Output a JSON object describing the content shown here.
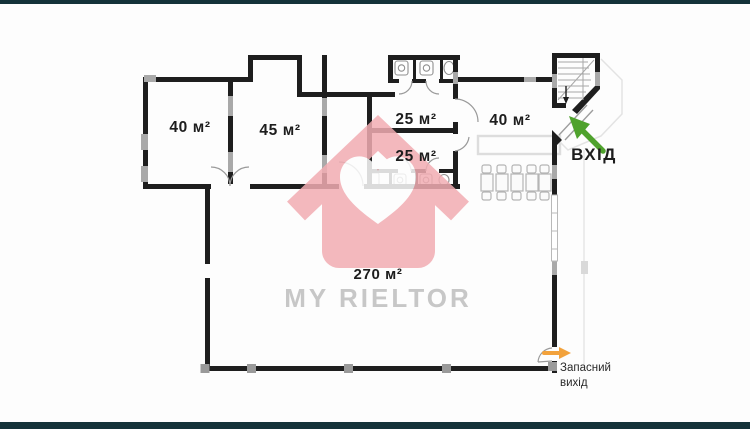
{
  "frame": {
    "bar_color": "#143239"
  },
  "plan": {
    "rooms": [
      {
        "name": "room-40-left",
        "label": "40 м²"
      },
      {
        "name": "room-45",
        "label": "45 м²"
      },
      {
        "name": "room-25-top",
        "label": "25 м²"
      },
      {
        "name": "room-25-bottom",
        "label": "25 м²"
      },
      {
        "name": "room-40-right",
        "label": "40 м²"
      },
      {
        "name": "hall-270",
        "label": "270 м²"
      }
    ],
    "entrance": {
      "label": "ВХІД",
      "arrow_color": "#4fa22d"
    },
    "emergency_exit": {
      "label_line1": "Запасний",
      "label_line2": "вихід",
      "arrow_color": "#f2a23c"
    },
    "colors": {
      "wall": "#1e1e1e",
      "window_marker": "#a9a9a9",
      "pillar": "#9a9a9a",
      "door_arc": "#9a9a9a",
      "stair_line": "#a8a8a8",
      "furniture": "#b5b5b5",
      "canopy": "#e3e3e3"
    }
  },
  "watermark": {
    "brand": "MY RIELTOR",
    "house_color": "#f2adb3",
    "text_color": "#c7c7c7"
  }
}
